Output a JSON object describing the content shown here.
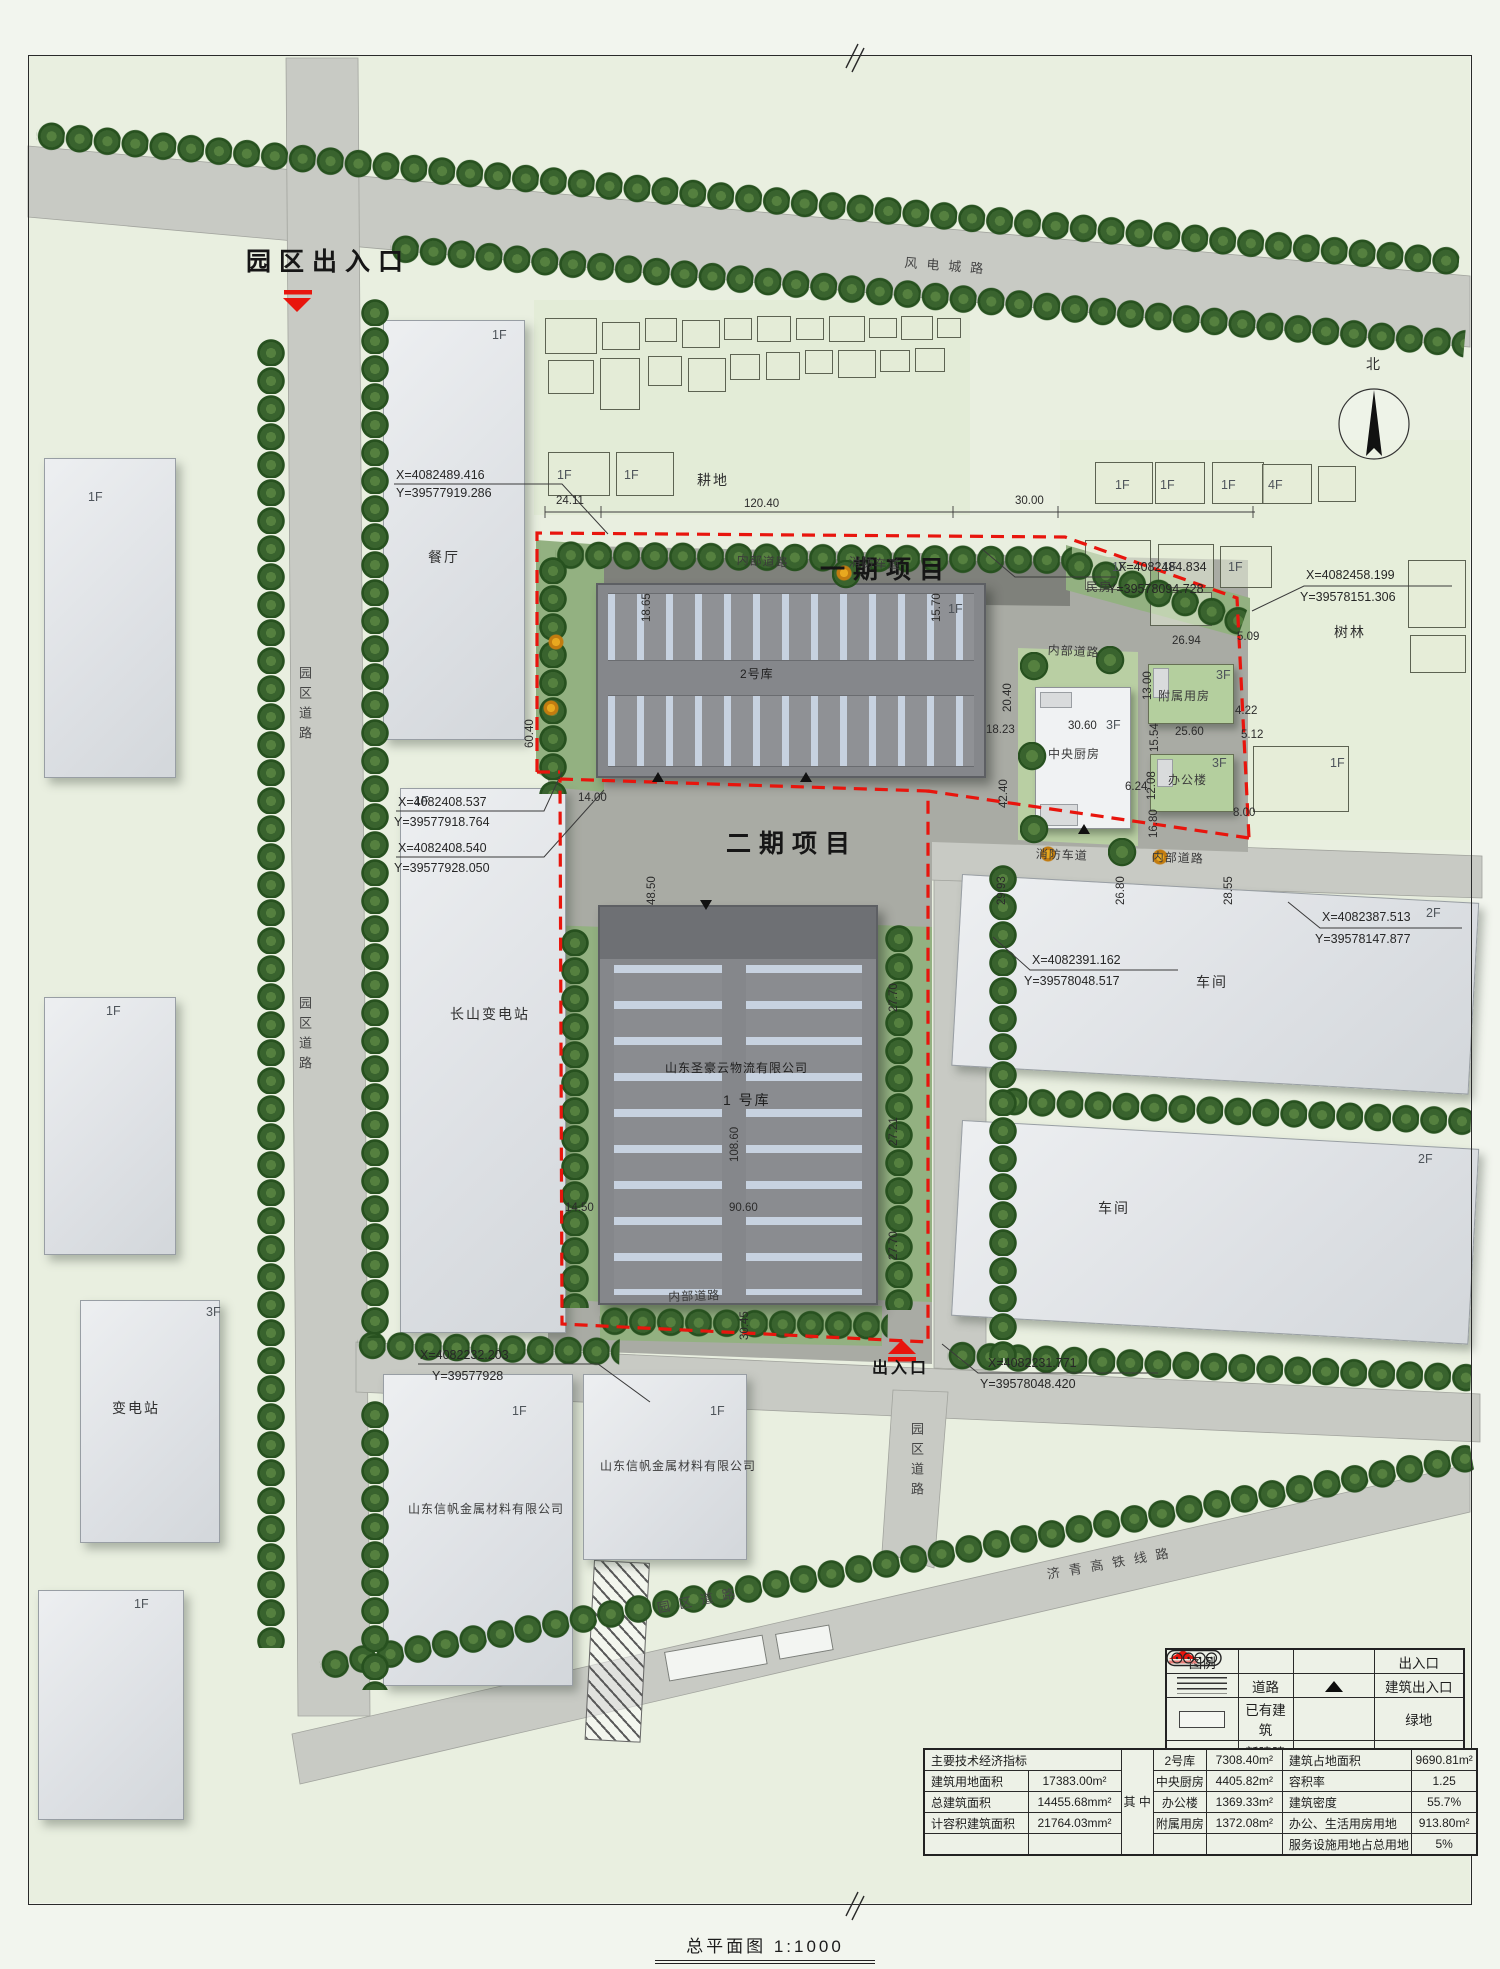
{
  "title": {
    "text": "总平面图 1:1000"
  },
  "legend": {
    "title": "图例",
    "road": "道路",
    "existing": "已有建筑",
    "new": "新建建筑",
    "entrance": "出入口",
    "bldg_entrance": "建筑出入口",
    "green": "绿地",
    "parking": "停车位"
  },
  "econ": {
    "header": "主要技术经济指标",
    "among": "其\n中",
    "rows_left": [
      {
        "label": "建筑用地面积",
        "value": "17383.00m²"
      },
      {
        "label": "总建筑面积",
        "value": "14455.68mm²"
      },
      {
        "label": "计容积建筑面积",
        "value": "21764.03mm²"
      },
      {
        "label": "",
        "value": ""
      }
    ],
    "rows_mid": [
      {
        "label": "2号库",
        "value": "7308.40m²"
      },
      {
        "label": "中央厨房",
        "value": "4405.82m²"
      },
      {
        "label": "办公楼",
        "value": "1369.33m²"
      },
      {
        "label": "附属用房",
        "value": "1372.08m²"
      },
      {
        "label": "",
        "value": ""
      }
    ],
    "rows_right": [
      {
        "label": "建筑占地面积",
        "value": "9690.81m²"
      },
      {
        "label": "容积率",
        "value": "1.25"
      },
      {
        "label": "建筑密度",
        "value": "55.7%"
      },
      {
        "label": "办公、生活用房用地",
        "value": "913.80m²"
      },
      {
        "label": "服务设施用地占总用地",
        "value": "5%"
      }
    ]
  },
  "annotations": [
    {
      "n": "park-entrance-label",
      "t": "园区出入口",
      "x": 246,
      "y": 248,
      "c": "xl"
    },
    {
      "n": "road-name-windpower",
      "t": "风电城路",
      "x": 905,
      "y": 256,
      "c": "rd",
      "r": 4.5
    },
    {
      "n": "phase1-label",
      "t": "一期项目",
      "x": 820,
      "y": 556,
      "c": "xl"
    },
    {
      "n": "phase2-label",
      "t": "二期项目",
      "x": 726,
      "y": 830,
      "c": "xl"
    },
    {
      "n": "internal-road-label",
      "t": "内部道路",
      "x": 737,
      "y": 554,
      "c": "sm",
      "r": 3
    },
    {
      "n": "fire-lane-label",
      "t": "消防车道",
      "x": 849,
      "y": 556,
      "c": "sm",
      "r": 3
    },
    {
      "n": "internal-road-label",
      "t": "内部道路",
      "x": 1048,
      "y": 644,
      "c": "sm",
      "r": 3
    },
    {
      "n": "fire-lane-label",
      "t": "消防车道",
      "x": 1036,
      "y": 848,
      "c": "sm",
      "r": 2
    },
    {
      "n": "internal-road-label",
      "t": "内部道路",
      "x": 1152,
      "y": 851,
      "c": "sm",
      "r": 2
    },
    {
      "n": "internal-road-label",
      "t": "内部道路",
      "x": 668,
      "y": 1291,
      "c": "sm",
      "r": -2
    },
    {
      "n": "farmland-label",
      "t": "耕地",
      "x": 697,
      "y": 472,
      "c": "md"
    },
    {
      "n": "woods-label",
      "t": "树林",
      "x": 1334,
      "y": 624,
      "c": "md"
    },
    {
      "n": "minfang-label",
      "t": "民房",
      "x": 1086,
      "y": 581,
      "c": "sm"
    },
    {
      "n": "canteen-label",
      "t": "餐厅",
      "x": 428,
      "y": 549,
      "c": "md"
    },
    {
      "n": "changshan-substation-label",
      "t": "长山变电站",
      "x": 450,
      "y": 1006,
      "c": "md"
    },
    {
      "n": "substation-label",
      "t": "变电站",
      "x": 112,
      "y": 1400,
      "c": "md"
    },
    {
      "n": "workshop-label",
      "t": "车间",
      "x": 1196,
      "y": 974,
      "c": "md"
    },
    {
      "n": "workshop-label",
      "t": "车间",
      "x": 1098,
      "y": 1200,
      "c": "md"
    },
    {
      "n": "site-entrance-label",
      "t": "出入口",
      "x": 872,
      "y": 1360,
      "c": "lg"
    },
    {
      "n": "north-label",
      "t": "北",
      "x": 1366,
      "y": 356,
      "c": "md"
    },
    {
      "n": "road-name-park",
      "t": "园区道路",
      "x": 296,
      "y": 666,
      "c": "vert"
    },
    {
      "n": "road-name-park",
      "t": "园区道路",
      "x": 296,
      "y": 996,
      "c": "vert"
    },
    {
      "n": "road-name-park",
      "t": "园区道路",
      "x": 908,
      "y": 1422,
      "c": "vert"
    },
    {
      "n": "road-name-park",
      "t": "园区道路",
      "x": 656,
      "y": 1602,
      "c": "rd",
      "r": -11
    },
    {
      "n": "road-name-rail",
      "t": "济青高铁线路",
      "x": 1046,
      "y": 1568,
      "c": "rd",
      "r": -10
    },
    {
      "n": "warehouse2-label",
      "t": "2号库",
      "x": 740,
      "y": 668,
      "c": "sm onroof"
    },
    {
      "n": "warehouse1-company-label",
      "t": "山东圣豪云物流有限公司",
      "x": 665,
      "y": 1062,
      "c": "sm onroof"
    },
    {
      "n": "warehouse1-label",
      "t": "1 号库",
      "x": 723,
      "y": 1092,
      "c": "md onroof"
    },
    {
      "n": "kitchen-label",
      "t": "中央厨房",
      "x": 1048,
      "y": 748,
      "c": "sm"
    },
    {
      "n": "kitchen-dim",
      "t": "30.60",
      "x": 1068,
      "y": 720,
      "c": "dim"
    },
    {
      "n": "kitchen-floors",
      "t": "3F",
      "x": 1106,
      "y": 718,
      "c": "fl"
    },
    {
      "n": "aux-label",
      "t": "附属用房",
      "x": 1158,
      "y": 690,
      "c": "sm"
    },
    {
      "n": "aux-floors",
      "t": "3F",
      "x": 1216,
      "y": 668,
      "c": "fl"
    },
    {
      "n": "office-label",
      "t": "办公楼",
      "x": 1168,
      "y": 774,
      "c": "sm"
    },
    {
      "n": "office-floors",
      "t": "3F",
      "x": 1212,
      "y": 756,
      "c": "fl"
    },
    {
      "n": "company1-label",
      "t": "山东信帆金属材料有限公司",
      "x": 408,
      "y": 1503,
      "c": "sm"
    },
    {
      "n": "company2-label",
      "t": "山东信帆金属材料有限公司",
      "x": 600,
      "y": 1460,
      "c": "sm"
    },
    {
      "n": "floor-label",
      "t": "1F",
      "x": 88,
      "y": 490,
      "c": "fl"
    },
    {
      "n": "floor-label",
      "t": "1F",
      "x": 492,
      "y": 328,
      "c": "fl"
    },
    {
      "n": "floor-label",
      "t": "1F",
      "x": 106,
      "y": 1004,
      "c": "fl"
    },
    {
      "n": "floor-label",
      "t": "3F",
      "x": 206,
      "y": 1305,
      "c": "fl"
    },
    {
      "n": "floor-label",
      "t": "1F",
      "x": 134,
      "y": 1597,
      "c": "fl"
    },
    {
      "n": "floor-label",
      "t": "1F",
      "x": 414,
      "y": 794,
      "c": "fl"
    },
    {
      "n": "floor-label",
      "t": "1F",
      "x": 948,
      "y": 602,
      "c": "fl"
    },
    {
      "n": "floor-label",
      "t": "2F",
      "x": 1426,
      "y": 906,
      "c": "fl"
    },
    {
      "n": "floor-label",
      "t": "2F",
      "x": 1418,
      "y": 1152,
      "c": "fl"
    },
    {
      "n": "floor-label",
      "t": "1F",
      "x": 512,
      "y": 1404,
      "c": "fl"
    },
    {
      "n": "floor-label",
      "t": "1F",
      "x": 710,
      "y": 1404,
      "c": "fl"
    },
    {
      "n": "floor-label",
      "t": "1F",
      "x": 557,
      "y": 468,
      "c": "fl"
    },
    {
      "n": "floor-label",
      "t": "1F",
      "x": 624,
      "y": 468,
      "c": "fl"
    },
    {
      "n": "floor-label",
      "t": "1F",
      "x": 1115,
      "y": 478,
      "c": "fl"
    },
    {
      "n": "floor-label",
      "t": "1F",
      "x": 1160,
      "y": 478,
      "c": "fl"
    },
    {
      "n": "floor-label",
      "t": "1F",
      "x": 1221,
      "y": 478,
      "c": "fl"
    },
    {
      "n": "floor-label",
      "t": "4F",
      "x": 1268,
      "y": 478,
      "c": "fl"
    },
    {
      "n": "floor-label",
      "t": "1F",
      "x": 1112,
      "y": 560,
      "c": "fl"
    },
    {
      "n": "floor-label",
      "t": "1F",
      "x": 1162,
      "y": 560,
      "c": "fl"
    },
    {
      "n": "floor-label",
      "t": "1F",
      "x": 1228,
      "y": 560,
      "c": "fl"
    },
    {
      "n": "floor-label",
      "t": "1F",
      "x": 1330,
      "y": 756,
      "c": "fl"
    },
    {
      "n": "dim-label",
      "t": "24.11",
      "x": 556,
      "y": 495,
      "c": "dim"
    },
    {
      "n": "dim-label",
      "t": "120.40",
      "x": 744,
      "y": 498,
      "c": "dim"
    },
    {
      "n": "dim-label",
      "t": "30.00",
      "x": 1015,
      "y": 495,
      "c": "dim"
    },
    {
      "n": "dim-label",
      "t": "18.65",
      "x": 641,
      "y": 622,
      "c": "dim",
      "r": -90
    },
    {
      "n": "dim-label",
      "t": "15.70",
      "x": 931,
      "y": 622,
      "c": "dim",
      "r": -90
    },
    {
      "n": "dim-label",
      "t": "60.40",
      "x": 524,
      "y": 748,
      "c": "dim",
      "r": -90
    },
    {
      "n": "dim-label",
      "t": "20.40",
      "x": 1002,
      "y": 712,
      "c": "dim",
      "r": -90
    },
    {
      "n": "dim-label",
      "t": "18.23",
      "x": 986,
      "y": 724,
      "c": "dim"
    },
    {
      "n": "dim-label",
      "t": "42.40",
      "x": 998,
      "y": 808,
      "c": "dim",
      "r": -90
    },
    {
      "n": "dim-label",
      "t": "14.00",
      "x": 578,
      "y": 792,
      "c": "dim"
    },
    {
      "n": "dim-label",
      "t": "48.50",
      "x": 646,
      "y": 905,
      "c": "dim",
      "r": -90
    },
    {
      "n": "dim-label",
      "t": "29.93",
      "x": 996,
      "y": 905,
      "c": "dim",
      "r": -90
    },
    {
      "n": "dim-label",
      "t": "26.80",
      "x": 1115,
      "y": 905,
      "c": "dim",
      "r": -90
    },
    {
      "n": "dim-label",
      "t": "28.55",
      "x": 1223,
      "y": 905,
      "c": "dim",
      "r": -90
    },
    {
      "n": "dim-label",
      "t": "108.60",
      "x": 729,
      "y": 1162,
      "c": "dim",
      "r": -90
    },
    {
      "n": "dim-label",
      "t": "14.50",
      "x": 565,
      "y": 1202,
      "c": "dim"
    },
    {
      "n": "dim-label",
      "t": "90.60",
      "x": 729,
      "y": 1202,
      "c": "dim"
    },
    {
      "n": "dim-label",
      "t": "30.45",
      "x": 739,
      "y": 1340,
      "c": "dim",
      "r": -90
    },
    {
      "n": "dim-label",
      "t": "27.70",
      "x": 888,
      "y": 1012,
      "c": "dim",
      "r": -90
    },
    {
      "n": "dim-label",
      "t": "27.21",
      "x": 888,
      "y": 1146,
      "c": "dim",
      "r": -90
    },
    {
      "n": "dim-label",
      "t": "27.70",
      "x": 888,
      "y": 1260,
      "c": "dim",
      "r": -90
    },
    {
      "n": "dim-label",
      "t": "26.94",
      "x": 1172,
      "y": 635,
      "c": "dim"
    },
    {
      "n": "dim-label",
      "t": "13.00",
      "x": 1142,
      "y": 700,
      "c": "dim",
      "r": -90
    },
    {
      "n": "dim-label",
      "t": "15.54",
      "x": 1149,
      "y": 752,
      "c": "dim",
      "r": -90
    },
    {
      "n": "dim-label",
      "t": "4.22",
      "x": 1235,
      "y": 705,
      "c": "dim"
    },
    {
      "n": "dim-label",
      "t": "25.60",
      "x": 1175,
      "y": 726,
      "c": "dim"
    },
    {
      "n": "dim-label",
      "t": "5.12",
      "x": 1241,
      "y": 729,
      "c": "dim"
    },
    {
      "n": "dim-label",
      "t": "12.08",
      "x": 1146,
      "y": 800,
      "c": "dim",
      "r": -90
    },
    {
      "n": "dim-label",
      "t": "16.80",
      "x": 1148,
      "y": 838,
      "c": "dim",
      "r": -90
    },
    {
      "n": "dim-label",
      "t": "6.24",
      "x": 1125,
      "y": 781,
      "c": "dim"
    },
    {
      "n": "dim-label",
      "t": "8.00",
      "x": 1233,
      "y": 807,
      "c": "dim"
    },
    {
      "n": "dim-label",
      "t": "5.09",
      "x": 1237,
      "y": 631,
      "c": "dim"
    },
    {
      "n": "coord-label",
      "t": "X=4082489.416",
      "x": 396,
      "y": 468,
      "c": "coord"
    },
    {
      "n": "coord-label",
      "t": "Y=39577919.286",
      "x": 396,
      "y": 486,
      "c": "coord"
    },
    {
      "n": "coord-label",
      "t": "X=4082484.834",
      "x": 1118,
      "y": 560,
      "c": "coord"
    },
    {
      "n": "coord-label",
      "t": "Y=39578094.728",
      "x": 1108,
      "y": 582,
      "c": "coord"
    },
    {
      "n": "coord-label",
      "t": "X=4082458.199",
      "x": 1306,
      "y": 568,
      "c": "coord"
    },
    {
      "n": "coord-label",
      "t": "Y=39578151.306",
      "x": 1300,
      "y": 590,
      "c": "coord"
    },
    {
      "n": "coord-label",
      "t": "X=4082408.537",
      "x": 398,
      "y": 795,
      "c": "coord"
    },
    {
      "n": "coord-label",
      "t": "Y=39577918.764",
      "x": 394,
      "y": 815,
      "c": "coord"
    },
    {
      "n": "coord-label",
      "t": "X=4082408.540",
      "x": 398,
      "y": 841,
      "c": "coord"
    },
    {
      "n": "coord-label",
      "t": "Y=39577928.050",
      "x": 394,
      "y": 861,
      "c": "coord"
    },
    {
      "n": "coord-label",
      "t": "X=4082391.162",
      "x": 1032,
      "y": 953,
      "c": "coord"
    },
    {
      "n": "coord-label",
      "t": "Y=39578048.517",
      "x": 1024,
      "y": 974,
      "c": "coord"
    },
    {
      "n": "coord-label",
      "t": "X=4082387.513",
      "x": 1322,
      "y": 910,
      "c": "coord"
    },
    {
      "n": "coord-label",
      "t": "Y=39578147.877",
      "x": 1315,
      "y": 932,
      "c": "coord"
    },
    {
      "n": "coord-label",
      "t": "X=4082232.203",
      "x": 420,
      "y": 1348,
      "c": "coord"
    },
    {
      "n": "coord-label",
      "t": "Y=39577928",
      "x": 432,
      "y": 1369,
      "c": "coord"
    },
    {
      "n": "coord-label",
      "t": "X=4082231.771",
      "x": 988,
      "y": 1356,
      "c": "coord"
    },
    {
      "n": "coord-label",
      "t": "Y=39578048.420",
      "x": 980,
      "y": 1377,
      "c": "coord"
    }
  ]
}
